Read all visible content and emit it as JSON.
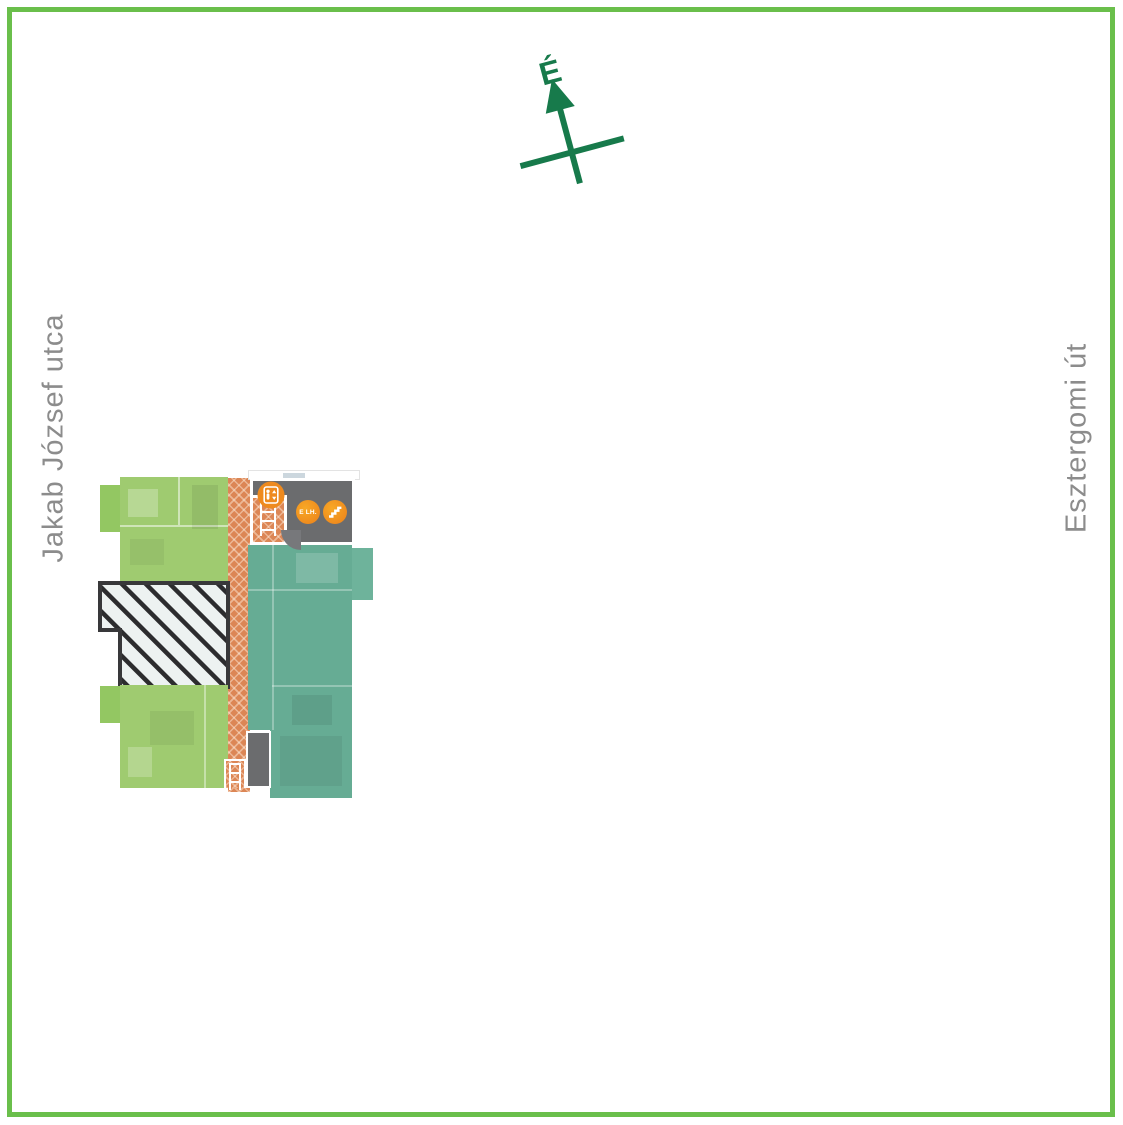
{
  "compass": {
    "label": "É"
  },
  "streets": {
    "left": "Jakab József utca",
    "right": "Esztergomi út"
  },
  "plan": {
    "core": {
      "elevator_badge": "E LH."
    }
  },
  "icons": {
    "north": "north-arrow-icon",
    "elevator": "elevator-icon",
    "stairs": "stairs-icon"
  },
  "colors": {
    "frame_green": "#6abf4b",
    "compass_green": "#177a4b",
    "street_label_gray": "#8c8c8c",
    "unit_green": "#9fcb70",
    "unit_teal": "#66ac94",
    "corridor_orange": "#dc8655",
    "core_gray": "#6b6c6e",
    "icon_orange": "#ee8a1e",
    "hatch_background": "#edf2f1",
    "hatch_stripe": "#2c2c2e"
  }
}
